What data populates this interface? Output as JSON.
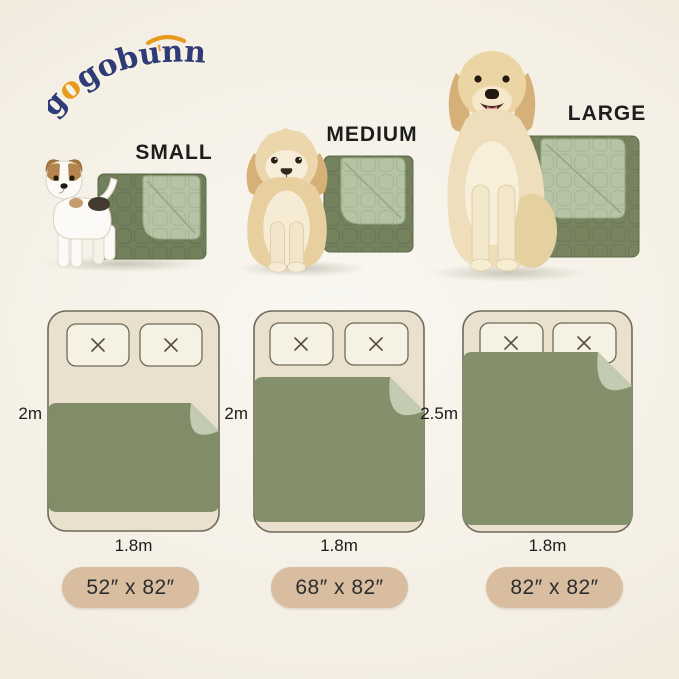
{
  "logo": {
    "text": "gogobunny",
    "part1": "g",
    "part2": "o",
    "part3": "gobunny"
  },
  "sizes": [
    {
      "label": "SMALL",
      "bed_length": "2m",
      "bed_width": "1.8m",
      "dimensions": "52″ x 82″"
    },
    {
      "label": "MEDIUM",
      "bed_length": "2m",
      "bed_width": "1.8m",
      "dimensions": "68″ x 82″"
    },
    {
      "label": "LARGE",
      "bed_length": "2.5m",
      "bed_width": "1.8m",
      "dimensions": "82″ x 82″"
    }
  ],
  "colors": {
    "brand_navy": "#2e3b76",
    "brand_orange": "#e89a1f",
    "blanket_green": "#72805c",
    "blanket_fold_green": "#b6c3a4",
    "bed_fill": "#e9e1cd",
    "bed_outline": "#6f6a5a",
    "badge_tan": "#d8bda0",
    "background_beige": "#f1ebdf",
    "text": "#1d1d1d"
  }
}
